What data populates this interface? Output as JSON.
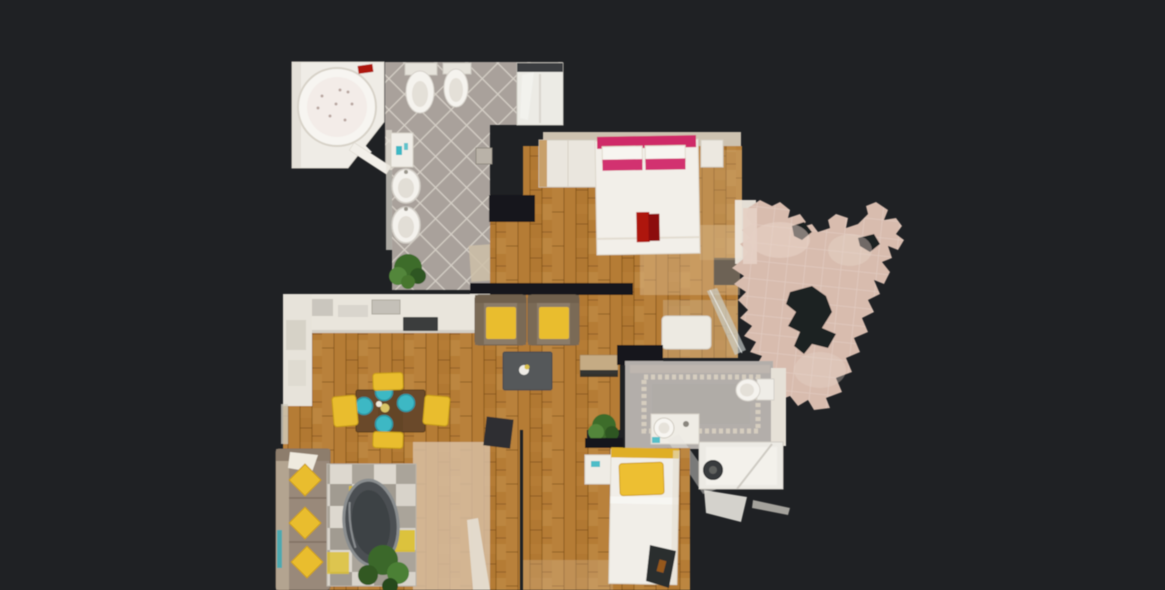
{
  "view": {
    "type": "3d-scan-floorplan-top-down",
    "background": "#1f2124"
  },
  "colors": {
    "background": "#1f2124",
    "wall_dark": "#17191b",
    "wood_floor": "#b57c35",
    "wood_line": "#6e4012",
    "tile_floor": "#a9a19b",
    "tile_line": "#d6d0c7",
    "bath2_floor": "#b3aeaa",
    "bath2_border": "#d9d0c1",
    "terrace_floor": "#d8bcae",
    "wall_light": "#cdc2b0",
    "fixture_white": "#f2efe9",
    "counter_white": "#e9e5dc",
    "accent_yellow": "#e9bd2d",
    "accent_teal": "#3cb8c4",
    "accent_pink": "#cf2a68",
    "accent_pink_deep": "#d23070",
    "accent_red": "#ae1410",
    "table_brown": "#6b4a2c",
    "coffee_table_gray": "#55585a",
    "sofa_taupe": "#99897a",
    "plant_green": "#3e6c2c",
    "rug_light": "#d8d3ca",
    "rug_dark": "#a19b91"
  },
  "rooms": [
    {
      "name": "main-bathroom",
      "floor": "grey-diamond-tile",
      "furniture": [
        "corner-jacuzzi-tub",
        "red-towel",
        "bidet",
        "toilet",
        "shower-cabin",
        "vanity-cabinet",
        "wall-sink",
        "wall-sink",
        "bath-mat",
        "potted-plant",
        "scale"
      ]
    },
    {
      "name": "master-bedroom",
      "floor": "wood-planks",
      "furniture": [
        "double-bed",
        "pink-headboard",
        "pink-pillows",
        "red-clothes-on-bed",
        "wardrobe",
        "bedside-table",
        "terrace-door-curtain",
        "console-desk",
        "open-glass-door"
      ]
    },
    {
      "name": "living-dining-room",
      "floor": "wood-planks",
      "furniture": [
        "kitchen-counter",
        "cooktop",
        "armchair",
        "armchair",
        "coffee-table",
        "dining-table",
        "teal-plates",
        "dining-chair",
        "dining-chair",
        "dining-chair",
        "dining-chair",
        "sofa-with-yellow-cushions",
        "checkered-rug",
        "oval-side-table",
        "potted-plant",
        "potted-plant",
        "wall-shelf",
        "dark-chair"
      ]
    },
    {
      "name": "second-bathroom",
      "floor": "grey-tile-mosaic-border",
      "furniture": [
        "toilet",
        "vanity-sink",
        "shower-enclosure"
      ]
    },
    {
      "name": "second-bedroom",
      "floor": "wood-planks",
      "furniture": [
        "single-bed-yellow-pillow",
        "nightstand",
        "dark-bag"
      ]
    },
    {
      "name": "terrace",
      "floor": "partially-scanned-stone",
      "furniture": []
    }
  ]
}
